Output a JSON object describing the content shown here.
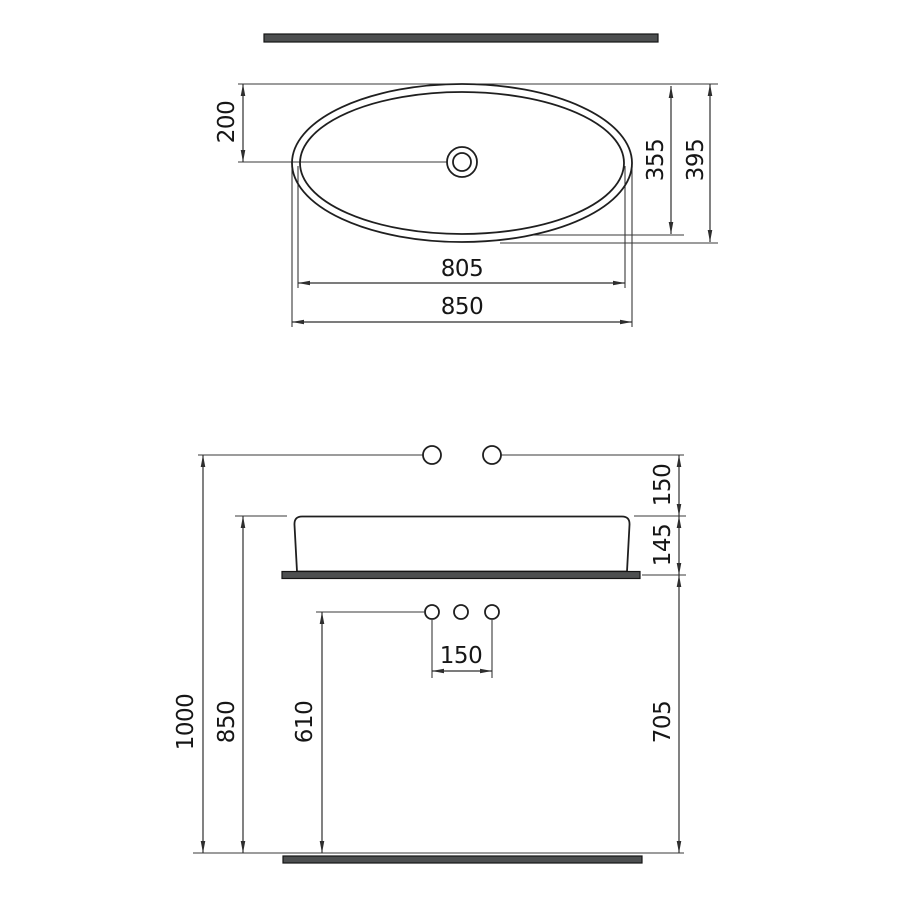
{
  "figure": {
    "type": "technical-drawing",
    "subject": "oval countertop washbasin installation dimensions",
    "units": "mm"
  },
  "colors": {
    "background": "#ffffff",
    "dimension_line": "#2e2e2e",
    "object_line": "#1f1f1f",
    "slab_fill": "#4d4f50",
    "text": "#161616"
  },
  "top_view": {
    "dims": {
      "center_offset": "200",
      "basin_inner_width": "355",
      "basin_outer_width": "395",
      "basin_inner_length": "805",
      "basin_outer_length": "850"
    }
  },
  "elevation_view": {
    "dims": {
      "wall_holes_above_rim": "150",
      "basin_height": "145",
      "total_height": "1000",
      "worktop_height": "850",
      "deck_holes_height": "610",
      "deck_holes_spacing": "150",
      "below_worktop": "705"
    }
  }
}
